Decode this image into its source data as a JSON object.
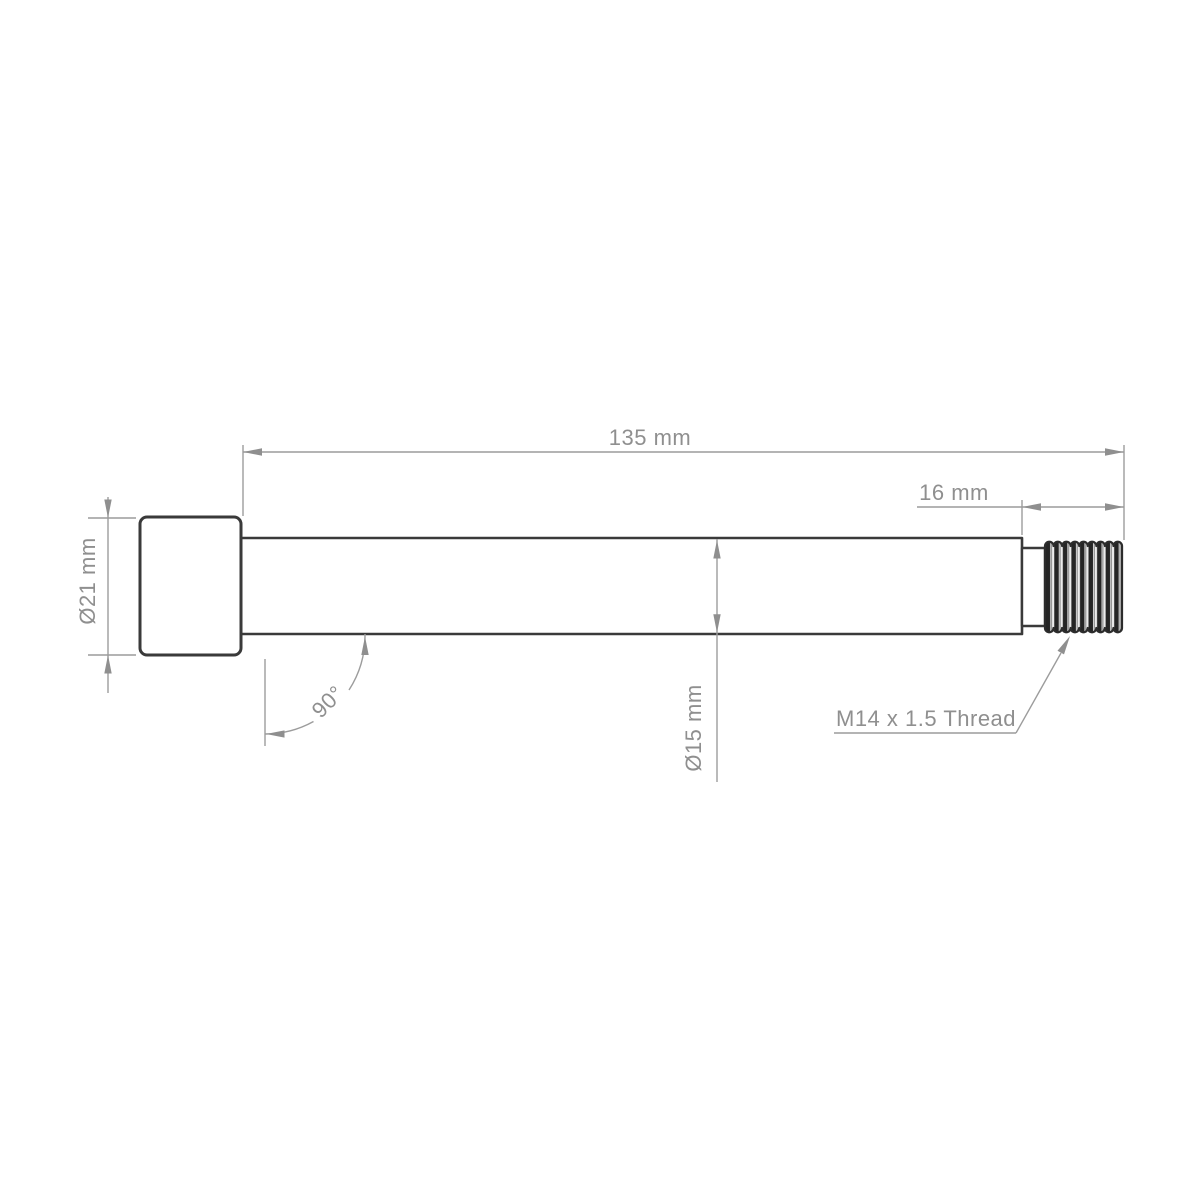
{
  "drawing": {
    "kind": "engineering-dimension-drawing",
    "labels": {
      "overall_length": "135 mm",
      "thread_length": "16 mm",
      "head_diameter": "Ø21 mm",
      "shaft_diameter": "Ø15 mm",
      "head_angle": "90°",
      "thread_spec": "M14 x 1.5 Thread"
    },
    "colors": {
      "background": "#ffffff",
      "part_outline": "#3a3a3a",
      "thread_dark": "#252525",
      "dimension_lines": "#9c9c9c",
      "dimension_text": "#8f8f8f"
    }
  }
}
